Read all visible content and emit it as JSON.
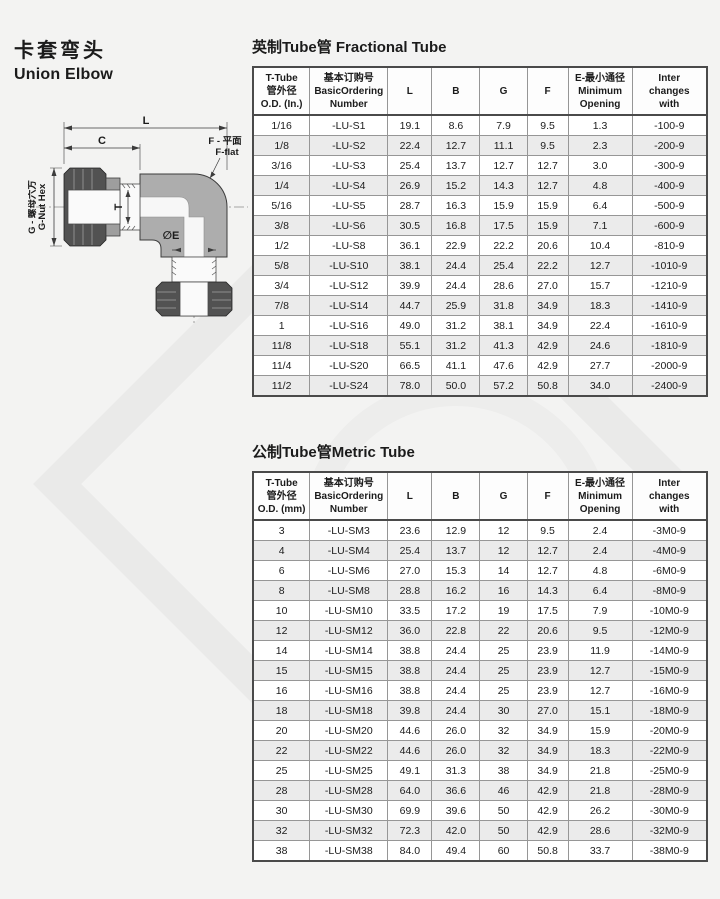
{
  "header": {
    "title_zh": "卡套弯头",
    "title_en": "Union Elbow"
  },
  "drawing": {
    "labels": {
      "dim_l": "L",
      "dim_c": "C",
      "dim_t": "T",
      "nut_hex_zh": "G - 螺母六方",
      "nut_hex_en": "G-Nut Hex",
      "flat_zh": "F - 平面",
      "flat_en": "F-flat",
      "bore": "∅E"
    }
  },
  "fractional_table": {
    "title": "英制Tube管 Fractional Tube",
    "headers": [
      {
        "lines": [
          "T-Tube",
          "管外径",
          "O.D. (In.)"
        ]
      },
      {
        "lines": [
          "基本订购号",
          "BasicOrdering",
          "Number"
        ]
      },
      {
        "lines": [
          "L"
        ]
      },
      {
        "lines": [
          "B"
        ]
      },
      {
        "lines": [
          "G"
        ]
      },
      {
        "lines": [
          "F"
        ]
      },
      {
        "lines": [
          "E-最小通径",
          "Minimum",
          "Opening"
        ]
      },
      {
        "lines": [
          "Inter",
          "changes",
          "with"
        ]
      }
    ],
    "rows": [
      [
        "1/16",
        "-LU-S1",
        "19.1",
        "8.6",
        "7.9",
        "9.5",
        "1.3",
        "-100-9"
      ],
      [
        "1/8",
        "-LU-S2",
        "22.4",
        "12.7",
        "11.1",
        "9.5",
        "2.3",
        "-200-9"
      ],
      [
        "3/16",
        "-LU-S3",
        "25.4",
        "13.7",
        "12.7",
        "12.7",
        "3.0",
        "-300-9"
      ],
      [
        "1/4",
        "-LU-S4",
        "26.9",
        "15.2",
        "14.3",
        "12.7",
        "4.8",
        "-400-9"
      ],
      [
        "5/16",
        "-LU-S5",
        "28.7",
        "16.3",
        "15.9",
        "15.9",
        "6.4",
        "-500-9"
      ],
      [
        "3/8",
        "-LU-S6",
        "30.5",
        "16.8",
        "17.5",
        "15.9",
        "7.1",
        "-600-9"
      ],
      [
        "1/2",
        "-LU-S8",
        "36.1",
        "22.9",
        "22.2",
        "20.6",
        "10.4",
        "-810-9"
      ],
      [
        "5/8",
        "-LU-S10",
        "38.1",
        "24.4",
        "25.4",
        "22.2",
        "12.7",
        "-1010-9"
      ],
      [
        "3/4",
        "-LU-S12",
        "39.9",
        "24.4",
        "28.6",
        "27.0",
        "15.7",
        "-1210-9"
      ],
      [
        "7/8",
        "-LU-S14",
        "44.7",
        "25.9",
        "31.8",
        "34.9",
        "18.3",
        "-1410-9"
      ],
      [
        "1",
        "-LU-S16",
        "49.0",
        "31.2",
        "38.1",
        "34.9",
        "22.4",
        "-1610-9"
      ],
      [
        "11/8",
        "-LU-S18",
        "55.1",
        "31.2",
        "41.3",
        "42.9",
        "24.6",
        "-1810-9"
      ],
      [
        "11/4",
        "-LU-S20",
        "66.5",
        "41.1",
        "47.6",
        "42.9",
        "27.7",
        "-2000-9"
      ],
      [
        "11/2",
        "-LU-S24",
        "78.0",
        "50.0",
        "57.2",
        "50.8",
        "34.0",
        "-2400-9"
      ]
    ]
  },
  "metric_table": {
    "title": "公制Tube管Metric Tube",
    "headers": [
      {
        "lines": [
          "T-Tube",
          "管外径",
          "O.D. (mm)"
        ]
      },
      {
        "lines": [
          "基本订购号",
          "BasicOrdering",
          "Number"
        ]
      },
      {
        "lines": [
          "L"
        ]
      },
      {
        "lines": [
          "B"
        ]
      },
      {
        "lines": [
          "G"
        ]
      },
      {
        "lines": [
          "F"
        ]
      },
      {
        "lines": [
          "E-最小通径",
          "Minimum",
          "Opening"
        ]
      },
      {
        "lines": [
          "Inter",
          "changes",
          "with"
        ]
      }
    ],
    "rows": [
      [
        "3",
        "-LU-SM3",
        "23.6",
        "12.9",
        "12",
        "9.5",
        "2.4",
        "-3M0-9"
      ],
      [
        "4",
        "-LU-SM4",
        "25.4",
        "13.7",
        "12",
        "12.7",
        "2.4",
        "-4M0-9"
      ],
      [
        "6",
        "-LU-SM6",
        "27.0",
        "15.3",
        "14",
        "12.7",
        "4.8",
        "-6M0-9"
      ],
      [
        "8",
        "-LU-SM8",
        "28.8",
        "16.2",
        "16",
        "14.3",
        "6.4",
        "-8M0-9"
      ],
      [
        "10",
        "-LU-SM10",
        "33.5",
        "17.2",
        "19",
        "17.5",
        "7.9",
        "-10M0-9"
      ],
      [
        "12",
        "-LU-SM12",
        "36.0",
        "22.8",
        "22",
        "20.6",
        "9.5",
        "-12M0-9"
      ],
      [
        "14",
        "-LU-SM14",
        "38.8",
        "24.4",
        "25",
        "23.9",
        "11.9",
        "-14M0-9"
      ],
      [
        "15",
        "-LU-SM15",
        "38.8",
        "24.4",
        "25",
        "23.9",
        "12.7",
        "-15M0-9"
      ],
      [
        "16",
        "-LU-SM16",
        "38.8",
        "24.4",
        "25",
        "23.9",
        "12.7",
        "-16M0-9"
      ],
      [
        "18",
        "-LU-SM18",
        "39.8",
        "24.4",
        "30",
        "27.0",
        "15.1",
        "-18M0-9"
      ],
      [
        "20",
        "-LU-SM20",
        "44.6",
        "26.0",
        "32",
        "34.9",
        "15.9",
        "-20M0-9"
      ],
      [
        "22",
        "-LU-SM22",
        "44.6",
        "26.0",
        "32",
        "34.9",
        "18.3",
        "-22M0-9"
      ],
      [
        "25",
        "-LU-SM25",
        "49.1",
        "31.3",
        "38",
        "34.9",
        "21.8",
        "-25M0-9"
      ],
      [
        "28",
        "-LU-SM28",
        "64.0",
        "36.6",
        "46",
        "42.9",
        "21.8",
        "-28M0-9"
      ],
      [
        "30",
        "-LU-SM30",
        "69.9",
        "39.6",
        "50",
        "42.9",
        "26.2",
        "-30M0-9"
      ],
      [
        "32",
        "-LU-SM32",
        "72.3",
        "42.0",
        "50",
        "42.9",
        "28.6",
        "-32M0-9"
      ],
      [
        "38",
        "-LU-SM38",
        "84.0",
        "49.4",
        "60",
        "50.8",
        "33.7",
        "-38M0-9"
      ]
    ]
  },
  "colors": {
    "table_border": "#4a4a4a",
    "grid_line": "#969696",
    "row_alt": "#ebebeb",
    "body_gray": "#adadad",
    "nut_gray": "#525252"
  }
}
